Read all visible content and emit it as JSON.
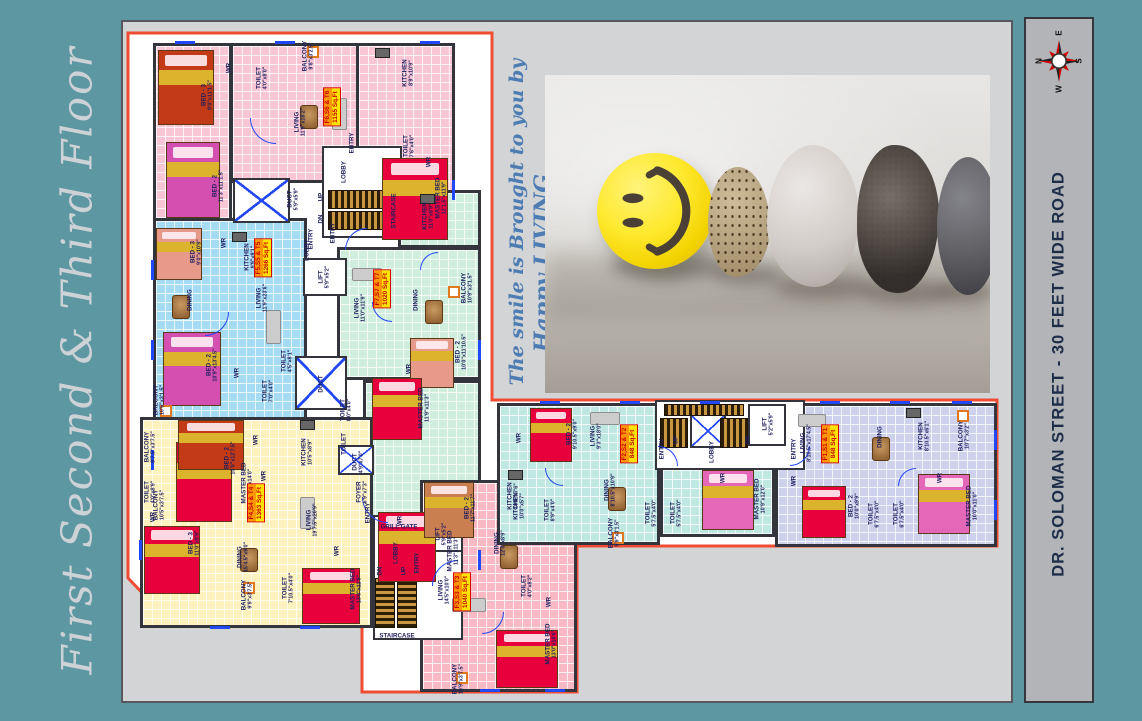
{
  "title_left": "First Second & Third Floor",
  "road_label": "DR. SOLOMAN STREET - 30 FEET WIDE ROAD",
  "promo": {
    "line1": "The smile is Brought to you by",
    "line2": "Happy LIVING..."
  },
  "compass": {
    "n": "N",
    "e": "E",
    "s": "S",
    "w": "W"
  },
  "colors": {
    "page_bg": "#5d97a2",
    "panel_bg": "#d3d4d6",
    "strip_bg": "#b2b4b7",
    "plan_outline": "#f04b33",
    "badge_orange": "#ff9800",
    "badge_yellow": "#ffe300",
    "badge_text": "#c80000",
    "wall": "#34343c",
    "fixture_blue": "#2247f5"
  },
  "units": [
    {
      "flats": "F6,S6 & T6",
      "area": "1155 Sq.Ft",
      "color": "pink",
      "x": 332,
      "y": 107
    },
    {
      "flats": "F5,S5 & T5",
      "area": "1266 Sq.Ft",
      "color": "blue",
      "x": 263,
      "y": 258
    },
    {
      "flats": "F7,S7 & T7",
      "area": "1020 Sq.Ft",
      "color": "green",
      "x": 382,
      "y": 289
    },
    {
      "flats": "F4,S4 & T4",
      "area": "1363 Sq.Ft",
      "color": "yellow",
      "x": 256,
      "y": 503
    },
    {
      "flats": "F3,S3 & T3",
      "area": "1040 Sq.Ft",
      "color": "rose",
      "x": 462,
      "y": 592
    },
    {
      "flats": "F2,S2 & T2",
      "area": "848 Sq.Ft",
      "color": "teal",
      "x": 629,
      "y": 444
    },
    {
      "flats": "F1,S1 & T1",
      "area": "848 Sq.Ft",
      "color": "lavender",
      "x": 830,
      "y": 444
    }
  ],
  "room_labels": [
    {
      "t": "BED - 3",
      "d": "9'0\"x11'1.5\"",
      "x": 207,
      "y": 95
    },
    {
      "t": "WR",
      "x": 229,
      "y": 68
    },
    {
      "t": "TOILET",
      "d": "4'0\"x8'0\"",
      "x": 262,
      "y": 78
    },
    {
      "t": "BALCONY",
      "d": "9'8\"x3'2.5\"",
      "x": 308,
      "y": 56
    },
    {
      "t": "KITCHEN",
      "d": "8'9\"x10'9\"",
      "x": 408,
      "y": 73
    },
    {
      "t": "LIVING",
      "d": "11'9\"x18'2\"",
      "x": 300,
      "y": 122
    },
    {
      "t": "TOILET",
      "d": "7'6\"x4'0\"",
      "x": 409,
      "y": 146
    },
    {
      "t": "WR",
      "x": 429,
      "y": 162
    },
    {
      "t": "MASTER BED",
      "d": "12'1.5\"x11'9\"",
      "x": 441,
      "y": 198
    },
    {
      "t": "BED - 2",
      "d": "11'3\"x11'1.5\"",
      "x": 218,
      "y": 186
    },
    {
      "t": "ENTRY",
      "x": 352,
      "y": 143
    },
    {
      "t": "LOBBY",
      "x": 344,
      "y": 172
    },
    {
      "t": "UP",
      "x": 321,
      "y": 197
    },
    {
      "t": "DN",
      "x": 321,
      "y": 219
    },
    {
      "t": "STAIRCASE",
      "x": 394,
      "y": 211
    },
    {
      "t": "DUCT",
      "d": "5'9\"x5'9\"",
      "x": 293,
      "y": 199
    },
    {
      "t": "ENTRY",
      "x": 311,
      "y": 239
    },
    {
      "t": "BED - 3",
      "d": "9'0\"x10'9\"",
      "x": 196,
      "y": 252
    },
    {
      "t": "WR",
      "x": 224,
      "y": 243
    },
    {
      "t": "KITCHEN",
      "d": "9'9\"x9'1\"",
      "x": 250,
      "y": 257
    },
    {
      "t": "DINING",
      "x": 190,
      "y": 300
    },
    {
      "t": "LIVING",
      "d": "11'9\"x23'6\"",
      "x": 262,
      "y": 298
    },
    {
      "t": "LOBBY",
      "x": 307,
      "y": 250
    },
    {
      "t": "LIFT",
      "d": "5'9\"x5'2\"",
      "x": 324,
      "y": 277
    },
    {
      "t": "BED - 2",
      "d": "10'9\"x13'4.5\"",
      "x": 212,
      "y": 365
    },
    {
      "t": "WR",
      "x": 237,
      "y": 373
    },
    {
      "t": "TOILET",
      "d": "4'5\"x8'1\"",
      "x": 287,
      "y": 361
    },
    {
      "t": "TOILET",
      "d": "7'0\"x4'0\"",
      "x": 268,
      "y": 391
    },
    {
      "t": "DUCT",
      "x": 321,
      "y": 384
    },
    {
      "t": "BALCONY",
      "d": "10'5\"x3'1.5\"",
      "x": 159,
      "y": 400
    },
    {
      "t": "MASTER BED",
      "d": "10'5\"x14'0\"",
      "x": 247,
      "y": 483
    },
    {
      "t": "WR",
      "x": 264,
      "y": 476
    },
    {
      "t": "BALCONY",
      "d": "10'5\"x3'7.5\"",
      "x": 159,
      "y": 505
    },
    {
      "t": "KITCHEN",
      "d": "11'0\"x8'9\"",
      "x": 428,
      "y": 216
    },
    {
      "t": "ENTRY",
      "x": 333,
      "y": 233
    },
    {
      "t": "LIVING",
      "d": "11'0\"x11'9\"",
      "x": 360,
      "y": 308
    },
    {
      "t": "DINING",
      "x": 416,
      "y": 300
    },
    {
      "t": "BALCONY",
      "d": "10'9\"x3'1.5\"",
      "x": 467,
      "y": 288
    },
    {
      "t": "BED - 2",
      "d": "10'0\"x11'10.5\"",
      "x": 461,
      "y": 352
    },
    {
      "t": "WR",
      "x": 409,
      "y": 369
    },
    {
      "t": "TOILET",
      "d": "8'0\"x4'0\"",
      "x": 346,
      "y": 410
    },
    {
      "t": "MASTER BED",
      "d": "11'9\"x11'3\"",
      "x": 424,
      "y": 408
    },
    {
      "t": "TOILET",
      "x": 344,
      "y": 444
    },
    {
      "t": "WR",
      "x": 400,
      "y": 521
    },
    {
      "t": "MASTER BED",
      "d": "11'3\"x11'3\"",
      "x": 453,
      "y": 551
    },
    {
      "t": "BALCONY",
      "d": "9'7.5\"x3'7.5\"",
      "x": 150,
      "y": 447
    },
    {
      "t": "BED - 2",
      "d": "10'0\"x12'7.5\"",
      "x": 230,
      "y": 458
    },
    {
      "t": "WR",
      "x": 256,
      "y": 440
    },
    {
      "t": "KITCHEN",
      "d": "10'5\"x8'9\"",
      "x": 307,
      "y": 452
    },
    {
      "t": "DUCT",
      "d": "4'9\"x7'0\"",
      "x": 358,
      "y": 462
    },
    {
      "t": "FOYER",
      "d": "6'9\"x7'3\"",
      "x": 362,
      "y": 492
    },
    {
      "t": "ENTRY",
      "x": 368,
      "y": 513
    },
    {
      "t": "TOILET",
      "d": "4'0\"x8'9\"",
      "x": 150,
      "y": 492
    },
    {
      "t": "WR",
      "x": 153,
      "y": 517
    },
    {
      "t": "BED - 3",
      "d": "11'0\"x9'9\"",
      "x": 194,
      "y": 543
    },
    {
      "t": "DINING",
      "d": "15'4.5\"x9'0\"",
      "x": 243,
      "y": 557
    },
    {
      "t": "LIVING",
      "d": "19'7.5\"x20'9\"",
      "x": 312,
      "y": 520
    },
    {
      "t": "BALCONY",
      "d": "9'9\"x3'7.5\"",
      "x": 247,
      "y": 595
    },
    {
      "t": "TOILET",
      "d": "7'10.5\"x4'0\"",
      "x": 288,
      "y": 588
    },
    {
      "t": "WR",
      "x": 337,
      "y": 551
    },
    {
      "t": "MASTER BED",
      "d": "13'0\"x11'9\"",
      "x": 356,
      "y": 589
    },
    {
      "t": "GRILL GATE",
      "x": 399,
      "y": 527,
      "h": 1
    },
    {
      "t": "LOBBY",
      "x": 396,
      "y": 553
    },
    {
      "t": "ENTRY",
      "x": 417,
      "y": 563
    },
    {
      "t": "DN",
      "x": 380,
      "y": 571
    },
    {
      "t": "UP",
      "x": 404,
      "y": 571
    },
    {
      "t": "STAIRCASE",
      "x": 397,
      "y": 636,
      "h": 1
    },
    {
      "t": "LIFT",
      "d": "5'9\"x5'2\"",
      "x": 441,
      "y": 534
    },
    {
      "t": "BED - 2",
      "d": "11'7\"x11'7\"",
      "x": 470,
      "y": 508
    },
    {
      "t": "KITCHEN",
      "d": "10'6\"x7'6\"",
      "x": 513,
      "y": 496
    },
    {
      "t": "DINING",
      "d": "12'0\"x8'9\"",
      "x": 500,
      "y": 543
    },
    {
      "t": "TOILET",
      "d": "8'9\"x4'0\"",
      "x": 550,
      "y": 510
    },
    {
      "t": "TOILET",
      "d": "4'0\"x8'2\"",
      "x": 527,
      "y": 586
    },
    {
      "t": "WR",
      "x": 549,
      "y": 602
    },
    {
      "t": "LIVING",
      "d": "14'5\"x10'0\"",
      "x": 444,
      "y": 590
    },
    {
      "t": "BALCONY",
      "d": "10'9\"x3'7.5\"",
      "x": 458,
      "y": 679
    },
    {
      "t": "MASTER BED",
      "d": "13'0\"x10'6\"",
      "x": 551,
      "y": 644
    },
    {
      "t": "BED - 2",
      "d": "9'10.5\"x9'0\"",
      "x": 572,
      "y": 434
    },
    {
      "t": "WR",
      "x": 519,
      "y": 438
    },
    {
      "t": "LIVING",
      "d": "9'3\"x18'0\"",
      "x": 596,
      "y": 436
    },
    {
      "t": "KITCHEN",
      "d": "10'0\"x5'7\"",
      "x": 519,
      "y": 506
    },
    {
      "t": "DINING",
      "d": "8'10.5\"x10'9\"",
      "x": 610,
      "y": 490
    },
    {
      "t": "BALCONY",
      "d": "9'9\"x3'1.5\"",
      "x": 614,
      "y": 533
    },
    {
      "t": "TOILET",
      "d": "5'7.5\"x4'0\"",
      "x": 651,
      "y": 513
    },
    {
      "t": "TOILET",
      "d": "5'7.5\"x4'0\"",
      "x": 676,
      "y": 513
    },
    {
      "t": "MASTER BED",
      "d": "10'9\"x12'0\"",
      "x": 760,
      "y": 499
    },
    {
      "t": "WR",
      "x": 723,
      "y": 478
    },
    {
      "t": "ENTRY",
      "x": 662,
      "y": 449
    },
    {
      "t": "UP",
      "x": 676,
      "y": 440
    },
    {
      "t": "DN",
      "x": 748,
      "y": 440
    },
    {
      "t": "LOBBY",
      "x": 712,
      "y": 452
    },
    {
      "t": "LIFT",
      "d": "5'2\"x5'9\"",
      "x": 768,
      "y": 424
    },
    {
      "t": "ENTRY",
      "x": 794,
      "y": 449
    },
    {
      "t": "LIVING",
      "d": "8'10.5\"x17'4.5\"",
      "x": 806,
      "y": 443
    },
    {
      "t": "DINING",
      "x": 880,
      "y": 437
    },
    {
      "t": "KITCHEN",
      "d": "8'10.5\"x6'1\"",
      "x": 924,
      "y": 436
    },
    {
      "t": "BALCONY",
      "d": "10'7\"x3'2\"",
      "x": 964,
      "y": 436
    },
    {
      "t": "WR",
      "x": 794,
      "y": 481
    },
    {
      "t": "BED - 2",
      "d": "10'0\"x9'9\"",
      "x": 854,
      "y": 506
    },
    {
      "t": "TOILET",
      "d": "6'7.5\"x4'0\"",
      "x": 874,
      "y": 514
    },
    {
      "t": "TOILET",
      "d": "6'7.5\"x4'0\"",
      "x": 899,
      "y": 514
    },
    {
      "t": "WR",
      "x": 940,
      "y": 478
    },
    {
      "t": "MASTER BED",
      "d": "10'0\"x11'0\"",
      "x": 972,
      "y": 506
    }
  ]
}
